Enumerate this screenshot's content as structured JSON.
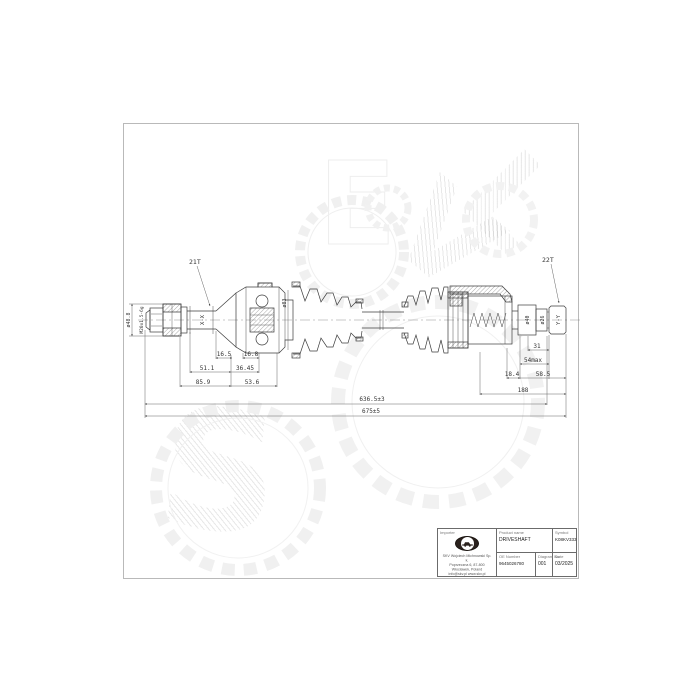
{
  "watermark": {
    "letters": [
      "S",
      "E",
      "V",
      "L"
    ]
  },
  "drawing": {
    "callouts": {
      "spline_left": "21T",
      "spline_right": "22T",
      "section_left": "X-X",
      "section_right": "Y-Y",
      "thread": "M20x1.5-6g",
      "dia_hub": "ø48.8",
      "dia_boot": "ø83",
      "dia_40": "ø40",
      "dia_26": "ø26"
    },
    "dims": {
      "d16_5": "16.5",
      "d16_8": "16.8",
      "d51_1": "51.1",
      "d36_45": "36.45",
      "d85_9": "85.9",
      "d53_6": "53.6",
      "d31": "31",
      "d54max": "54max",
      "d18_4": "18.4",
      "d58_5": "58.5",
      "d188": "188",
      "d636": "636.5±3",
      "d675": "675±5"
    }
  },
  "title_block": {
    "importer_label": "Importer",
    "address_line1": "SKV Wojciech Michnowski Sp. k.",
    "address_line2": "Poprzeczna 6, 87-800 Włocławek, Poland",
    "address_line3": "info@skv.pl www.skv.pl",
    "product_name_label": "Product name",
    "product_name": "DRIVESHAFT",
    "symbol_label": "Symbol",
    "symbol": "K08KV333",
    "oe_number_label": "OE Number",
    "oe_number": "9645026780",
    "diagram_no_label": "Diagram No",
    "diagram_no": "001",
    "date_label": "Date",
    "date": "03/2025"
  }
}
